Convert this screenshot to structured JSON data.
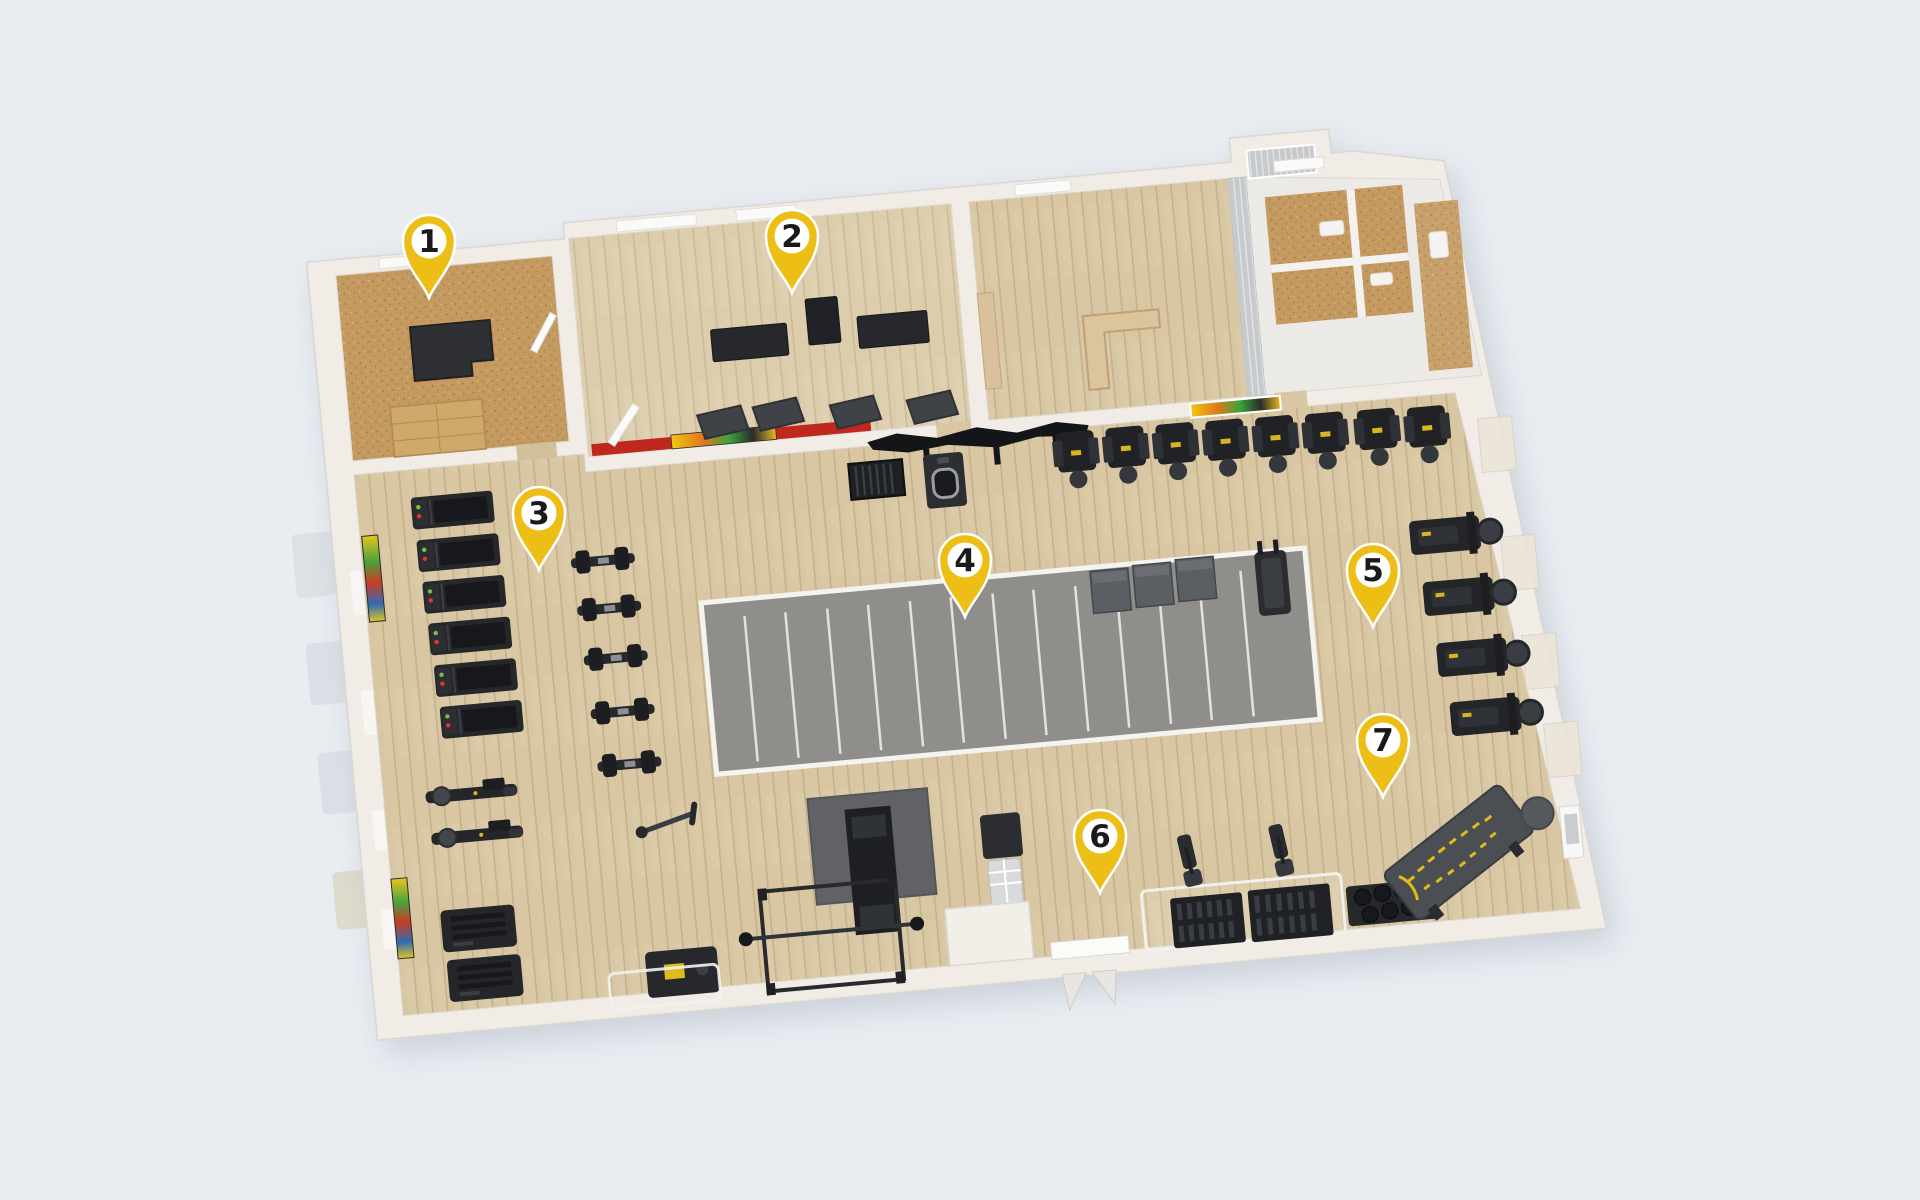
{
  "scene": {
    "background": "#e9edf2"
  },
  "pins": [
    {
      "label": "1",
      "transform": "translate(429,298)"
    },
    {
      "label": "2",
      "transform": "translate(792,293)"
    },
    {
      "label": "3",
      "transform": "translate(539,570)"
    },
    {
      "label": "4",
      "transform": "translate(965,617)"
    },
    {
      "label": "5",
      "transform": "translate(1373,627)"
    },
    {
      "label": "6",
      "transform": "translate(1100,893)"
    },
    {
      "label": "7",
      "transform": "translate(1383,797)"
    }
  ],
  "palette": {
    "pin_yellow": "#ecbe16",
    "pin_number": "#1a1a1c",
    "pin_ring": "#ffffff",
    "wall": "#f1ede6",
    "wood": "#d8c7a2",
    "cork": "#c49a60",
    "turf": "#8f8e8a",
    "turf_line": "#e8e7e4",
    "equipment_dark": "#222428",
    "mat_gray": "#606266",
    "accent_red": "#c0271e",
    "accent_yellow": "#e2bb1b",
    "gray_wall": "#c7cacd"
  }
}
